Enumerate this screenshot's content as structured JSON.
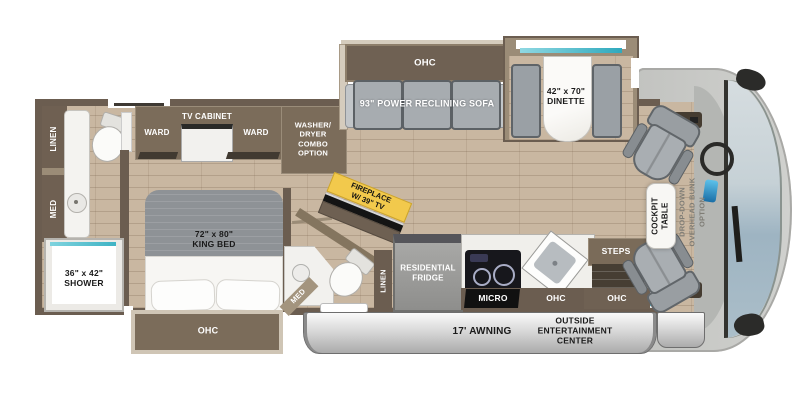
{
  "title": "Class A motorhome floor plan",
  "colors": {
    "wall": "#6b5d50",
    "cabinet": "#7b6c5a",
    "floor_wood": "#c9b7a1",
    "furniture_gray": "#a6abaf",
    "furniture_border": "#5f6468",
    "white_fixture": "#f6f5f2",
    "teal_glass": "#49b8c8",
    "fireplace_label_yellow": "#f2c94c",
    "awning_silver": "#cfcfcf",
    "windshield_blue": "#a9bcc7",
    "front_cap_gray": "#c7c8c5"
  },
  "labels": {
    "rear_bath": {
      "linen": "LINEN",
      "med": "MED"
    },
    "bedroom": {
      "ward_left": "WARD",
      "tv_cabinet": "TV CABINET",
      "ward_right": "WARD",
      "washer_dryer": "WASHER/\nDRYER\nCOMBO\nOPTION",
      "king_bed": "72\" x 80\"\nKING BED",
      "ohc": "OHC"
    },
    "shower": "36\" x 42\"\nSHOWER",
    "bath2": {
      "med": "MED",
      "linen": "LINEN"
    },
    "living": {
      "ohc": "OHC",
      "sofa": "93\" POWER RECLINING SOFA",
      "dinette": "42\" x 70\"\nDINETTE",
      "fireplace": "FIREPLACE\nW/ 39\" TV"
    },
    "kitchen": {
      "fridge": "RESIDENTIAL\nFRIDGE",
      "micro": "MICRO",
      "ohc": "OHC"
    },
    "entry": {
      "steps": "STEPS",
      "ohc": "OHC"
    },
    "cockpit": {
      "table": "COCKPIT\nTABLE",
      "bunk_option": "DROP-DOWN\nOVERHEAD BUNK\nOPTION"
    },
    "exterior": {
      "awning": "17' AWNING",
      "entertainment": "OUTSIDE\nENTERTAINMENT\nCENTER"
    }
  }
}
